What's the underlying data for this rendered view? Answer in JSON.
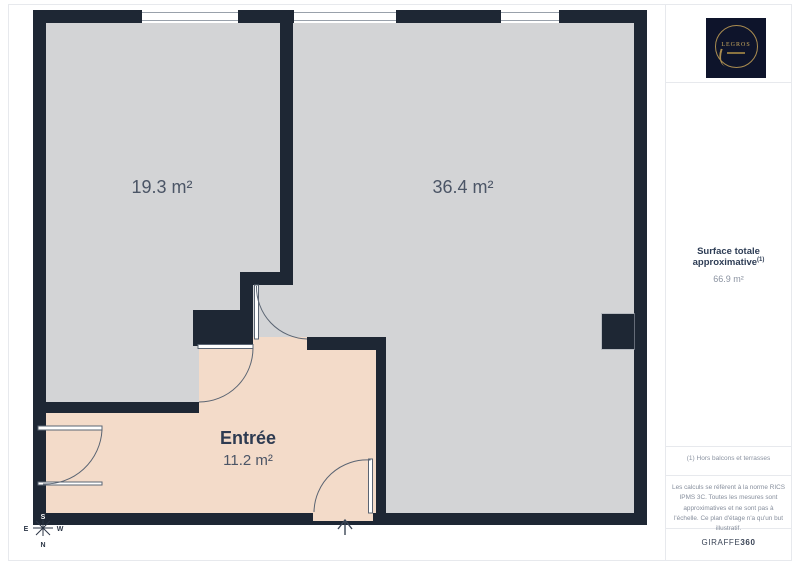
{
  "plan": {
    "rooms": [
      {
        "id": "room-1",
        "area_label": "19.3 m²"
      },
      {
        "id": "room-2",
        "area_label": "36.4 m²"
      },
      {
        "id": "entree",
        "name": "Entrée",
        "area_label": "11.2 m²"
      }
    ],
    "compass": {
      "north": "N",
      "south": "S",
      "east": "E",
      "west": "W"
    },
    "colors": {
      "wall": "#1e2734",
      "floor_gray": "#d3d4d6",
      "floor_pink": "#f3dbc9",
      "label_text": "#4b5566"
    }
  },
  "sidebar": {
    "logo_text": "LEGROS",
    "logo_colors": {
      "background": "#0e142b",
      "gold": "#ab8d50"
    },
    "surface_label": "Surface totale approximative",
    "surface_sup": "(1)",
    "surface_value": "66.9 m²",
    "footnote": "(1) Hors balcons et terrasses",
    "legal": "Les calculs se réfèrent à la norme RICS IPMS 3C. Toutes les mesures sont approximatives et ne sont pas à l'échelle. Ce plan d'étage n'a qu'un but illustratif.",
    "brand_name": "GIRAFFE",
    "brand_suffix": "360"
  }
}
